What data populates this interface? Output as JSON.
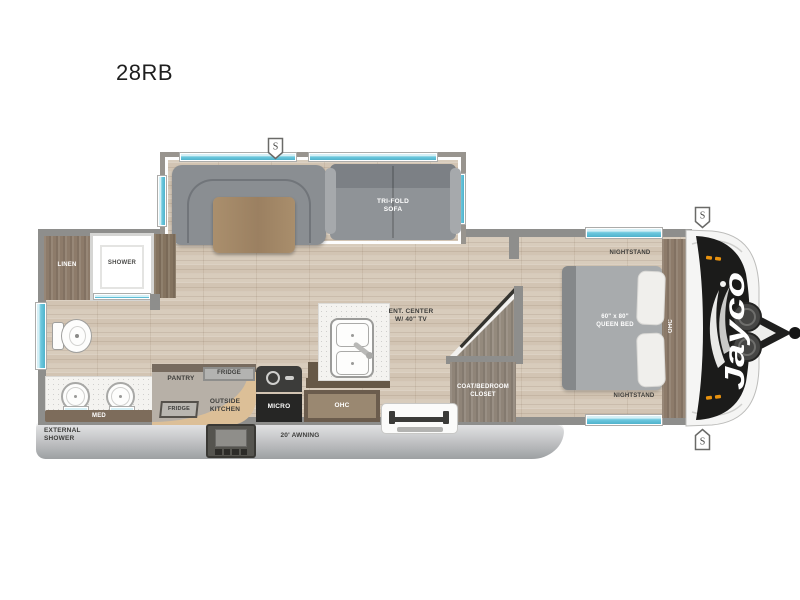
{
  "title": "28RB",
  "markers": {
    "s": "S"
  },
  "exterior": {
    "external_shower": "EXTERNAL\nSHOWER",
    "awning": "20' AWNING",
    "brand": "Jayco"
  },
  "bathroom": {
    "linen": "LINEN",
    "shower": "SHOWER",
    "med": "MED"
  },
  "kitchen": {
    "pantry": "PANTRY",
    "fridge": "FRIDGE",
    "outside_fridge": "FRIDGE",
    "outside_kitchen": "OUTSIDE\nKITCHEN",
    "micro": "MICRO",
    "ohc": "OHC"
  },
  "living": {
    "sofa": "TRI-FOLD\nSOFA",
    "ent_center": "ENT. CENTER\nW/ 40\" TV"
  },
  "bedroom": {
    "nightstand": "NIGHTSTAND",
    "bed": "60\" x 80\"\nQUEEN BED",
    "closet": "COAT/BEDROOM\nCLOSET",
    "ohc": "OHC"
  },
  "colors": {
    "window_teal": "#6fc9df",
    "front_cap_black": "#1b1b1a",
    "floor_wood": "#d8ccbc",
    "cabinet_wood": "#8d7b6a",
    "outside_kitchen_tan": "#dcbf97",
    "sofa_gray": "#8f9397",
    "awning_gray": "#c2c3c5",
    "marker_light_orange": "#e8920f"
  }
}
